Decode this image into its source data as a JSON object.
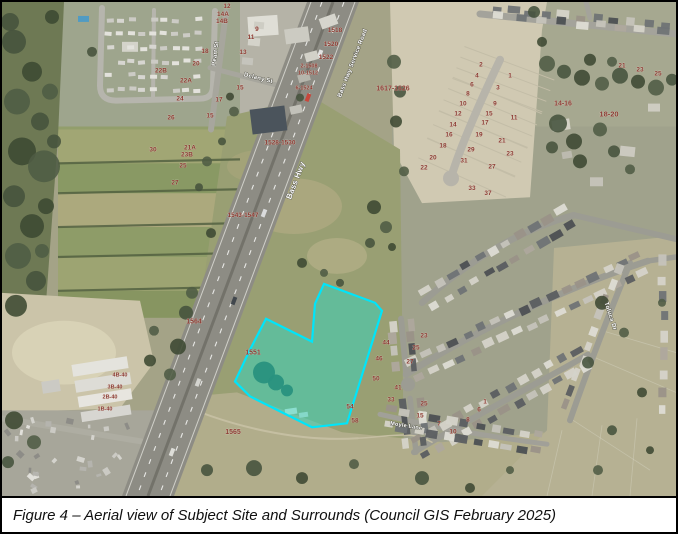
{
  "figure": {
    "caption": "Figure 4 – Aerial view of Subject Site and Surrounds (Council GIS February 2025)"
  },
  "map": {
    "site": {
      "label": "1551",
      "fill": "#2FD8BF",
      "fill_opacity": 0.5,
      "stroke": "#00E5FA",
      "stroke_width": 2.2,
      "polygon": [
        [
          233,
          381
        ],
        [
          247,
          351
        ],
        [
          264,
          318
        ],
        [
          310,
          341
        ],
        [
          313,
          303
        ],
        [
          322,
          283
        ],
        [
          373,
          302
        ],
        [
          380,
          310
        ],
        [
          345,
          423
        ],
        [
          310,
          427
        ],
        [
          280,
          412
        ],
        [
          248,
          396
        ]
      ]
    },
    "label_colors": {
      "street": "#ffffff",
      "street_halo": "#55554a",
      "parcel": "#8c3a32",
      "parcel_halo": "#efe9df"
    },
    "street_labels": [
      {
        "t": "Bass Hwy",
        "x": 296,
        "y": 180,
        "r": -69,
        "s": 8
      },
      {
        "t": "Bass Hwy Service Road",
        "x": 352,
        "y": 62,
        "r": -69,
        "s": 6
      },
      {
        "t": "Peart St",
        "x": 215,
        "y": 52,
        "r": -83,
        "s": 6
      },
      {
        "t": "Delany St",
        "x": 256,
        "y": 78,
        "r": 14,
        "s": 6
      },
      {
        "t": "Moyle Lane",
        "x": 404,
        "y": 427,
        "r": 9,
        "s": 5.5
      },
      {
        "t": "Toluca Dr",
        "x": 607,
        "y": 316,
        "r": 72,
        "s": 6
      }
    ],
    "parcel_labels": [
      [
        "1518",
        333,
        30
      ],
      [
        "1520",
        329,
        44
      ],
      [
        "1522",
        324,
        57
      ],
      [
        "2-1508",
        307,
        66,
        5.5
      ],
      [
        "10-1512",
        306,
        73,
        5.5
      ],
      [
        "6-1524",
        302,
        88,
        5.5
      ],
      [
        "1528-1530",
        278,
        143
      ],
      [
        "1543-1547",
        241,
        216
      ],
      [
        "1564",
        192,
        323,
        7
      ],
      [
        "1551",
        251,
        354,
        7
      ],
      [
        "1565",
        231,
        434,
        7
      ],
      [
        "1617-1626",
        391,
        89,
        7
      ],
      [
        "12",
        225,
        6
      ],
      [
        "14A",
        221,
        14
      ],
      [
        "14B",
        220,
        21
      ],
      [
        "18",
        203,
        51
      ],
      [
        "20",
        194,
        64
      ],
      [
        "22B",
        159,
        71
      ],
      [
        "22A",
        184,
        81
      ],
      [
        "24",
        178,
        99
      ],
      [
        "26",
        169,
        118
      ],
      [
        "9",
        255,
        29
      ],
      [
        "11",
        249,
        37
      ],
      [
        "13",
        241,
        52
      ],
      [
        "15",
        238,
        88
      ],
      [
        "17",
        217,
        100
      ],
      [
        "15",
        208,
        116
      ],
      [
        "30",
        151,
        150
      ],
      [
        "21A",
        188,
        148
      ],
      [
        "23B",
        185,
        155
      ],
      [
        "25",
        181,
        166
      ],
      [
        "27",
        173,
        183
      ],
      [
        "21",
        620,
        66
      ],
      [
        "23",
        638,
        70
      ],
      [
        "25",
        656,
        74
      ],
      [
        "14-16",
        561,
        104,
        7
      ],
      [
        "18-20",
        607,
        115,
        7.5
      ],
      [
        "2",
        479,
        65
      ],
      [
        "4",
        475,
        76
      ],
      [
        "6",
        470,
        85
      ],
      [
        "8",
        466,
        94
      ],
      [
        "10",
        461,
        104
      ],
      [
        "12",
        456,
        114
      ],
      [
        "14",
        451,
        125
      ],
      [
        "16",
        447,
        135
      ],
      [
        "18",
        441,
        146
      ],
      [
        "20",
        431,
        158
      ],
      [
        "22",
        422,
        168
      ],
      [
        "1",
        508,
        76
      ],
      [
        "3",
        496,
        88
      ],
      [
        "9",
        493,
        104
      ],
      [
        "15",
        487,
        114
      ],
      [
        "11",
        512,
        118
      ],
      [
        "17",
        483,
        123
      ],
      [
        "19",
        477,
        135
      ],
      [
        "21",
        500,
        141
      ],
      [
        "23",
        508,
        154
      ],
      [
        "29",
        469,
        150
      ],
      [
        "31",
        462,
        161
      ],
      [
        "27",
        490,
        167
      ],
      [
        "33",
        470,
        189
      ],
      [
        "37",
        486,
        194
      ],
      [
        "44",
        384,
        344
      ],
      [
        "46",
        377,
        360
      ],
      [
        "50",
        374,
        380
      ],
      [
        "41",
        396,
        389
      ],
      [
        "33",
        389,
        401
      ],
      [
        "54",
        348,
        408
      ],
      [
        "58",
        353,
        422
      ],
      [
        "23",
        422,
        337
      ],
      [
        "25",
        414,
        349
      ],
      [
        "27",
        408,
        363
      ],
      [
        "25",
        422,
        405
      ],
      [
        "15",
        418,
        417
      ],
      [
        "7",
        437,
        425
      ],
      [
        "1",
        483,
        403
      ],
      [
        "6",
        477,
        411
      ],
      [
        "8",
        466,
        421
      ],
      [
        "10",
        451,
        433
      ],
      [
        "4B-40",
        118,
        376,
        5.5
      ],
      [
        "3B-40",
        113,
        388,
        5.5
      ],
      [
        "2B-40",
        108,
        398,
        5.5
      ],
      [
        "1B-40",
        103,
        410,
        5.5
      ]
    ]
  }
}
